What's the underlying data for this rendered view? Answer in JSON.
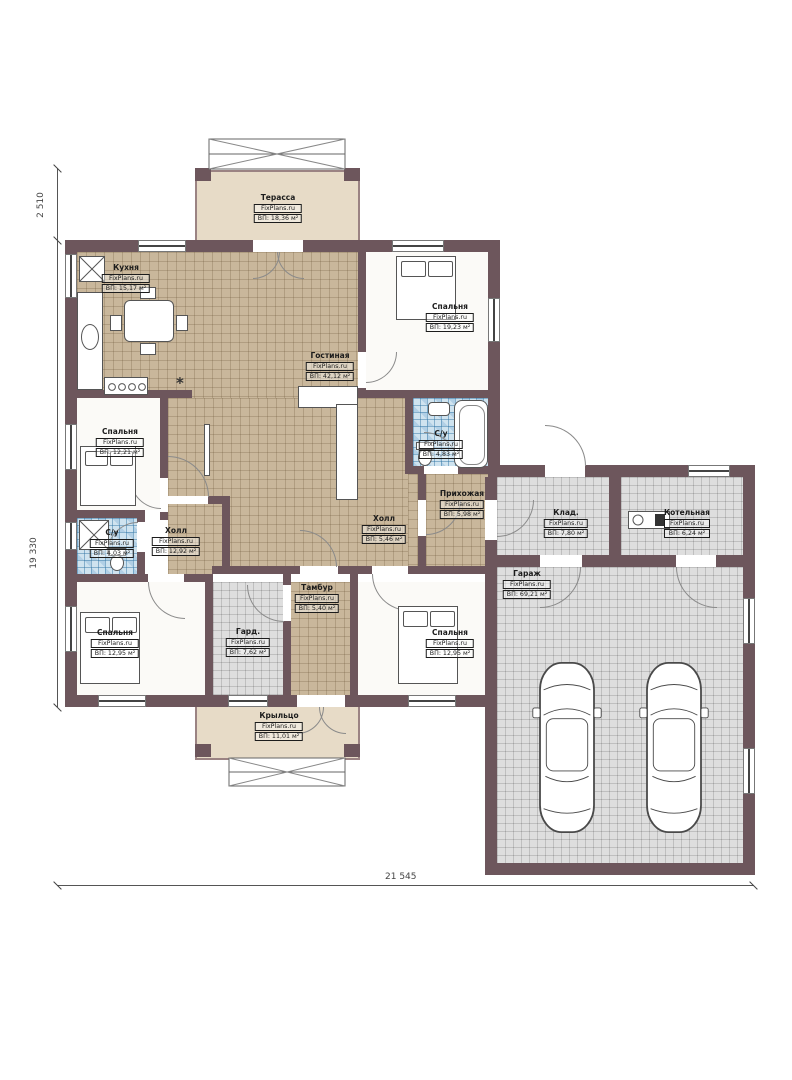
{
  "brand": "FixPlans.ru",
  "rooms": [
    {
      "key": "terrace",
      "name": "Терасса",
      "area": "ВП: 18,36 м²"
    },
    {
      "key": "kitchen",
      "name": "Кухня",
      "area": "ВП: 15,17 м²"
    },
    {
      "key": "bedroom-top-right",
      "name": "Спальня",
      "area": "ВП: 19,23 м²"
    },
    {
      "key": "living-room",
      "name": "Гостиная",
      "area": "ВП: 42,12 м²"
    },
    {
      "key": "bedroom-left",
      "name": "Спальня",
      "area": "ВП: 12,21 м²"
    },
    {
      "key": "bathroom-main",
      "name": "С/у",
      "area": "ВП: 4,83 м²"
    },
    {
      "key": "entry-hall",
      "name": "Прихожая",
      "area": "ВП: 5,98 м²"
    },
    {
      "key": "hall-small",
      "name": "Холл",
      "area": "ВП: 5,46 м²"
    },
    {
      "key": "hall",
      "name": "Холл",
      "area": "ВП: 12,92 м²"
    },
    {
      "key": "bathroom-left",
      "name": "С/у",
      "area": "ВП: 4,03 м²"
    },
    {
      "key": "tambour",
      "name": "Тамбур",
      "area": "ВП: 5,40 м²"
    },
    {
      "key": "wardrobe",
      "name": "Гард.",
      "area": "ВП: 7,62 м²"
    },
    {
      "key": "bedroom-bottom-left",
      "name": "Спальня",
      "area": "ВП: 12,95 м²"
    },
    {
      "key": "bedroom-bottom-mid",
      "name": "Спальня",
      "area": "ВП: 12,95 м²"
    },
    {
      "key": "porch",
      "name": "Крыльцо",
      "area": "ВП: 11,01 м²"
    },
    {
      "key": "storage",
      "name": "Клад.",
      "area": "ВП: 7,80 м²"
    },
    {
      "key": "boiler-room",
      "name": "Котельная",
      "area": "ВП: 6,24 м²"
    },
    {
      "key": "garage",
      "name": "Гараж",
      "area": "ВП: 69,21 м²"
    }
  ],
  "dimensions": {
    "left_upper": "2 510",
    "left_main": "19 330",
    "bottom": "21 545"
  },
  "colors": {
    "wall": "#6d565c",
    "floor_tan": "#c9b79b",
    "floor_grey": "#dedede",
    "floor_blue": "#cfe3ef",
    "terrace_beige": "#e7dbc7"
  }
}
